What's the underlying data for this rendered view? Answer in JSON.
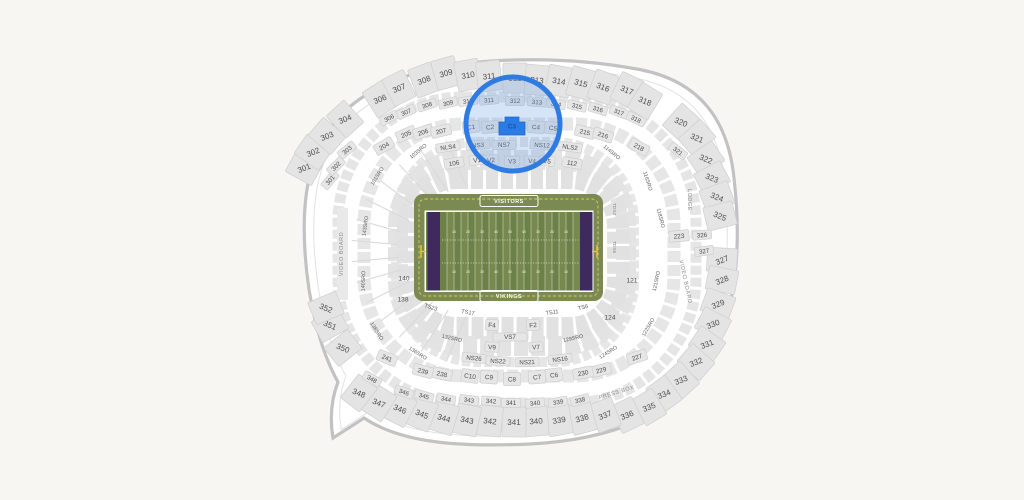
{
  "colors": {
    "background": "#f7f6f3",
    "outline": "#c2c2c2",
    "bowl_band": "#e5e5e5",
    "section_fill": "#e6e6e6",
    "section_stroke": "#cfcfcf",
    "section_text": "#4d4d4d",
    "sro_text": "#5c5c5c",
    "muted_text": "#8c8c8c",
    "highlight_stroke": "#2e7ce3",
    "highlight_fill_rgba": "rgba(120,166,228,0.30)",
    "selected_fill": "#2a7be3",
    "selected_text": "#17549e",
    "apron_green": "#7a8a52",
    "stripe_a": "#6c8147",
    "stripe_b": "#77894f",
    "endzone_purple": "#3e2a5c",
    "yellow_line": "#ddcb5e",
    "white": "#ffffff"
  },
  "highlight": {
    "circle": {
      "cx": 513,
      "cy": 124,
      "r": 47
    },
    "selected_section": "C3"
  },
  "field": {
    "visitors_label": "VISITORS",
    "vikings_label": "VIKINGS",
    "yard_numbers": [
      "10",
      "20",
      "30",
      "40",
      "50",
      "40",
      "30",
      "20",
      "10"
    ],
    "tds_labels": [
      {
        "label": "TDS2",
        "x": 613,
        "y": 209,
        "rot": 90
      },
      {
        "label": "TDS6",
        "x": 613,
        "y": 247,
        "rot": 90
      }
    ]
  },
  "misc_labels": {
    "video_board_left": {
      "label": "VIDEO BOARD",
      "x": 343,
      "y": 254,
      "rot": -90
    },
    "video_board_right": {
      "label": "VIDEO BOARD",
      "x": 684,
      "y": 282,
      "rot": 78
    },
    "lodge": {
      "label": "LODGE",
      "x": 688,
      "y": 200,
      "rot": 90
    },
    "press_box": {
      "label": "PRESS BOX",
      "x": 617,
      "y": 394,
      "rot": -17
    }
  },
  "sections": {
    "outer300": [
      {
        "label": "301",
        "x": 304,
        "y": 168
      },
      {
        "label": "302",
        "x": 313,
        "y": 152
      },
      {
        "label": "303",
        "x": 327,
        "y": 136
      },
      {
        "label": "304",
        "x": 345,
        "y": 119
      },
      {
        "label": "306",
        "x": 380,
        "y": 99
      },
      {
        "label": "307",
        "x": 399,
        "y": 88
      },
      {
        "label": "308",
        "x": 424,
        "y": 80
      },
      {
        "label": "309",
        "x": 446,
        "y": 73
      },
      {
        "label": "310",
        "x": 468,
        "y": 75
      },
      {
        "label": "311",
        "x": 489,
        "y": 76
      },
      {
        "label": "312",
        "x": 515,
        "y": 78
      },
      {
        "label": "313",
        "x": 537,
        "y": 80
      },
      {
        "label": "314",
        "x": 559,
        "y": 81
      },
      {
        "label": "315",
        "x": 581,
        "y": 83
      },
      {
        "label": "316",
        "x": 603,
        "y": 87
      },
      {
        "label": "317",
        "x": 627,
        "y": 90
      },
      {
        "label": "318",
        "x": 645,
        "y": 101
      },
      {
        "label": "320",
        "x": 681,
        "y": 122
      },
      {
        "label": "321",
        "x": 697,
        "y": 138
      },
      {
        "label": "322",
        "x": 706,
        "y": 159
      },
      {
        "label": "323",
        "x": 712,
        "y": 178
      },
      {
        "label": "324",
        "x": 717,
        "y": 197
      },
      {
        "label": "325",
        "x": 720,
        "y": 216
      },
      {
        "label": "327",
        "x": 722,
        "y": 260
      },
      {
        "label": "328",
        "x": 722,
        "y": 280
      },
      {
        "label": "329",
        "x": 718,
        "y": 304
      },
      {
        "label": "330",
        "x": 713,
        "y": 324
      },
      {
        "label": "331",
        "x": 707,
        "y": 344
      },
      {
        "label": "332",
        "x": 696,
        "y": 362
      },
      {
        "label": "333",
        "x": 681,
        "y": 380
      },
      {
        "label": "334",
        "x": 664,
        "y": 394
      },
      {
        "label": "335",
        "x": 649,
        "y": 407
      },
      {
        "label": "336",
        "x": 627,
        "y": 415
      },
      {
        "label": "337",
        "x": 605,
        "y": 415
      },
      {
        "label": "338",
        "x": 582,
        "y": 418
      },
      {
        "label": "339",
        "x": 559,
        "y": 420
      },
      {
        "label": "340",
        "x": 536,
        "y": 421
      },
      {
        "label": "341",
        "x": 514,
        "y": 422
      },
      {
        "label": "342",
        "x": 490,
        "y": 421
      },
      {
        "label": "343",
        "x": 467,
        "y": 420
      },
      {
        "label": "344",
        "x": 444,
        "y": 418
      },
      {
        "label": "345",
        "x": 422,
        "y": 414
      },
      {
        "label": "346",
        "x": 400,
        "y": 409
      },
      {
        "label": "347",
        "x": 379,
        "y": 403
      },
      {
        "label": "348",
        "x": 359,
        "y": 393
      },
      {
        "label": "350",
        "x": 343,
        "y": 348
      },
      {
        "label": "351",
        "x": 330,
        "y": 325
      },
      {
        "label": "352",
        "x": 326,
        "y": 308
      }
    ],
    "ring300_small": [
      {
        "label": "301",
        "x": 330,
        "y": 180,
        "rot": -50
      },
      {
        "label": "302",
        "x": 336,
        "y": 166,
        "rot": -45
      },
      {
        "label": "303",
        "x": 347,
        "y": 150,
        "rot": -40
      },
      {
        "label": "306",
        "x": 389,
        "y": 118,
        "rot": -28
      },
      {
        "label": "307",
        "x": 406,
        "y": 112,
        "rot": -24
      },
      {
        "label": "308",
        "x": 427,
        "y": 105,
        "rot": -18
      },
      {
        "label": "309",
        "x": 448,
        "y": 103,
        "rot": -13
      },
      {
        "label": "310",
        "x": 468,
        "y": 101,
        "rot": -9
      },
      {
        "label": "311",
        "x": 489,
        "y": 100,
        "rot": -5
      },
      {
        "label": "312",
        "x": 515,
        "y": 101,
        "rot": 0
      },
      {
        "label": "313",
        "x": 537,
        "y": 102,
        "rot": 5
      },
      {
        "label": "314",
        "x": 556,
        "y": 104,
        "rot": 9
      },
      {
        "label": "315",
        "x": 577,
        "y": 106,
        "rot": 13
      },
      {
        "label": "316",
        "x": 598,
        "y": 109,
        "rot": 17
      },
      {
        "label": "317",
        "x": 619,
        "y": 112,
        "rot": 21
      },
      {
        "label": "318",
        "x": 636,
        "y": 119,
        "rot": 26
      },
      {
        "label": "321",
        "x": 678,
        "y": 151,
        "rot": 38
      },
      {
        "label": "326",
        "x": 702,
        "y": 235,
        "rot": -5
      },
      {
        "label": "327",
        "x": 704,
        "y": 251,
        "rot": -8
      },
      {
        "label": "338",
        "x": 580,
        "y": 400,
        "rot": -14
      },
      {
        "label": "339",
        "x": 558,
        "y": 402,
        "rot": -10
      },
      {
        "label": "340",
        "x": 535,
        "y": 403,
        "rot": -6
      },
      {
        "label": "341",
        "x": 511,
        "y": 403,
        "rot": 0
      },
      {
        "label": "342",
        "x": 491,
        "y": 401,
        "rot": 4
      },
      {
        "label": "343",
        "x": 469,
        "y": 400,
        "rot": 8
      },
      {
        "label": "344",
        "x": 446,
        "y": 399,
        "rot": 12
      },
      {
        "label": "345",
        "x": 424,
        "y": 396,
        "rot": 16
      },
      {
        "label": "346",
        "x": 404,
        "y": 392,
        "rot": 20
      },
      {
        "label": "348",
        "x": 372,
        "y": 379,
        "rot": 30
      }
    ],
    "ring200": [
      {
        "label": "204",
        "x": 384,
        "y": 146,
        "rot": -30
      },
      {
        "label": "205",
        "x": 406,
        "y": 134,
        "rot": -24
      },
      {
        "label": "206",
        "x": 423,
        "y": 132,
        "rot": -18
      },
      {
        "label": "207",
        "x": 441,
        "y": 131,
        "rot": -13
      },
      {
        "label": "215",
        "x": 585,
        "y": 132,
        "rot": 14
      },
      {
        "label": "216",
        "x": 603,
        "y": 135,
        "rot": 18
      },
      {
        "label": "218",
        "x": 639,
        "y": 147,
        "rot": 28
      },
      {
        "label": "223",
        "x": 679,
        "y": 236,
        "rot": -5
      },
      {
        "label": "227",
        "x": 637,
        "y": 357,
        "rot": -18
      },
      {
        "label": "229",
        "x": 601,
        "y": 370,
        "rot": -15
      },
      {
        "label": "230",
        "x": 583,
        "y": 373,
        "rot": -11
      },
      {
        "label": "238",
        "x": 442,
        "y": 374,
        "rot": 12
      },
      {
        "label": "239",
        "x": 423,
        "y": 371,
        "rot": 15
      },
      {
        "label": "241",
        "x": 387,
        "y": 358,
        "rot": 22
      }
    ],
    "clubs_top": [
      {
        "label": "C1",
        "x": 471,
        "y": 127,
        "rot": -8
      },
      {
        "label": "C2",
        "x": 490,
        "y": 127,
        "rot": -4
      },
      {
        "label": "C3",
        "x": 512,
        "y": 126,
        "rot": 0,
        "selected": true
      },
      {
        "label": "C4",
        "x": 536,
        "y": 127,
        "rot": 4
      },
      {
        "label": "C5",
        "x": 553,
        "y": 128,
        "rot": 7
      }
    ],
    "ns_row_top": [
      {
        "label": "NLS4",
        "x": 448,
        "y": 147,
        "rot": -8
      },
      {
        "label": "NS3",
        "x": 478,
        "y": 145,
        "rot": -4
      },
      {
        "label": "NS7",
        "x": 504,
        "y": 145,
        "rot": 0
      },
      {
        "label": "NS12",
        "x": 542,
        "y": 145,
        "rot": 4
      },
      {
        "label": "NLS2",
        "x": 570,
        "y": 147,
        "rot": 8
      }
    ],
    "v_row_top": [
      {
        "label": "106",
        "x": 454,
        "y": 163,
        "rot": -10
      },
      {
        "label": "V1",
        "x": 477,
        "y": 160,
        "rot": -6
      },
      {
        "label": "V2",
        "x": 491,
        "y": 160,
        "rot": -4
      },
      {
        "label": "V3",
        "x": 512,
        "y": 161,
        "rot": 0
      },
      {
        "label": "V4",
        "x": 532,
        "y": 161,
        "rot": 4
      },
      {
        "label": "V5",
        "x": 547,
        "y": 161,
        "rot": 6
      },
      {
        "label": "112",
        "x": 572,
        "y": 163,
        "rot": 10
      }
    ],
    "ts_row": [
      {
        "label": "TS23",
        "x": 431,
        "y": 307,
        "rot": 18
      },
      {
        "label": "TS17",
        "x": 468,
        "y": 312,
        "rot": 10
      },
      {
        "label": "TS11",
        "x": 552,
        "y": 312,
        "rot": -8
      },
      {
        "label": "TS6",
        "x": 583,
        "y": 307,
        "rot": -15
      }
    ],
    "f_row": [
      {
        "label": "F4",
        "x": 492,
        "y": 325,
        "rot": 4
      },
      {
        "label": "F2",
        "x": 533,
        "y": 325,
        "rot": -4
      }
    ],
    "vs_row": [
      {
        "label": "VS7",
        "x": 510,
        "y": 337,
        "rot": 0
      }
    ],
    "v_row_bottom": [
      {
        "label": "V9",
        "x": 492,
        "y": 347,
        "rot": 3
      },
      {
        "label": "V7",
        "x": 536,
        "y": 347,
        "rot": -3
      }
    ],
    "ns_row_bottom": [
      {
        "label": "NS26",
        "x": 474,
        "y": 358,
        "rot": 6
      },
      {
        "label": "NS22",
        "x": 498,
        "y": 361,
        "rot": 3
      },
      {
        "label": "NS21",
        "x": 527,
        "y": 362,
        "rot": -2
      },
      {
        "label": "NS16",
        "x": 560,
        "y": 359,
        "rot": -7
      }
    ],
    "clubs_bottom": [
      {
        "label": "C10",
        "x": 470,
        "y": 376,
        "rot": 8
      },
      {
        "label": "C9",
        "x": 489,
        "y": 377,
        "rot": 4
      },
      {
        "label": "C8",
        "x": 512,
        "y": 379,
        "rot": 0
      },
      {
        "label": "C7",
        "x": 537,
        "y": 377,
        "rot": -4
      },
      {
        "label": "C6",
        "x": 554,
        "y": 375,
        "rot": -7
      }
    ],
    "inner100": [
      {
        "label": "140",
        "x": 404,
        "y": 278,
        "rot": 0
      },
      {
        "label": "138",
        "x": 403,
        "y": 299,
        "rot": 0
      },
      {
        "label": "121",
        "x": 632,
        "y": 280,
        "rot": 0
      },
      {
        "label": "124",
        "x": 610,
        "y": 317,
        "rot": 0
      }
    ],
    "sro": [
      {
        "label": "103SRO",
        "x": 418,
        "y": 151,
        "rot": -40
      },
      {
        "label": "114SRO",
        "x": 612,
        "y": 152,
        "rot": 40
      },
      {
        "label": "101SRO",
        "x": 377,
        "y": 176,
        "rot": -58
      },
      {
        "label": "143SRO",
        "x": 365,
        "y": 226,
        "rot": -82
      },
      {
        "label": "140SRO",
        "x": 363,
        "y": 281,
        "rot": -88
      },
      {
        "label": "138SRO",
        "x": 377,
        "y": 331,
        "rot": 58
      },
      {
        "label": "136SRO",
        "x": 418,
        "y": 353,
        "rot": 33
      },
      {
        "label": "132SRO",
        "x": 452,
        "y": 338,
        "rot": 13
      },
      {
        "label": "129SRO",
        "x": 573,
        "y": 338,
        "rot": -13
      },
      {
        "label": "124SRO",
        "x": 608,
        "y": 352,
        "rot": -33
      },
      {
        "label": "122SRO",
        "x": 648,
        "y": 327,
        "rot": -60
      },
      {
        "label": "121SRO",
        "x": 656,
        "y": 281,
        "rot": -78
      },
      {
        "label": "118SRO",
        "x": 661,
        "y": 218,
        "rot": 76
      },
      {
        "label": "116SRO",
        "x": 648,
        "y": 181,
        "rot": 72
      }
    ]
  }
}
